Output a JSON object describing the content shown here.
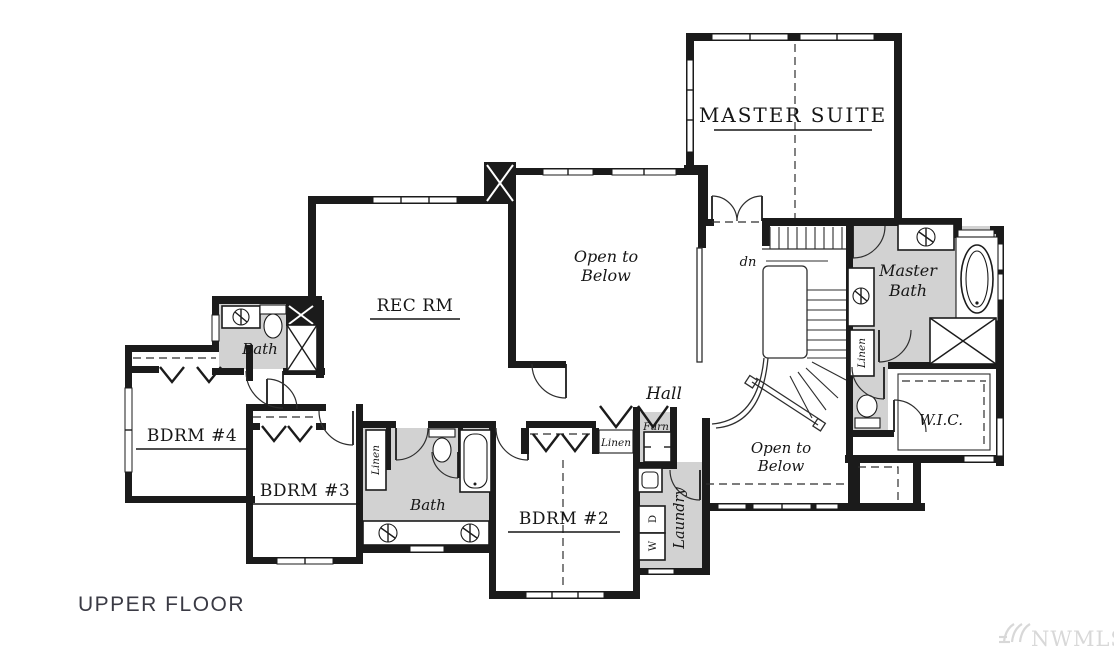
{
  "plan": {
    "floor_label": "UPPER FLOOR",
    "watermark_text": "NWMLS",
    "colors": {
      "wall": "#1b1b1b",
      "room_shading": "#d2d2d2",
      "thin_line": "#2e2e2e",
      "label_text": "#161616",
      "floor_label_text": "#3a3a44",
      "watermark": "#d8d8d8",
      "background": "#ffffff"
    },
    "rooms": {
      "master_suite": "MASTER SUITE",
      "rec_room": "REC RM",
      "open_to_below_upper_line1": "Open to",
      "open_to_below_upper_line2": "Below",
      "open_to_below_lower_line1": "Open to",
      "open_to_below_lower_line2": "Below",
      "hall": "Hall",
      "bath_upper": "Bath",
      "bath_lower": "Bath",
      "bedroom4": "BDRM #4",
      "bedroom3": "BDRM #3",
      "bedroom2": "BDRM #2",
      "master_bath_line1": "Master",
      "master_bath_line2": "Bath",
      "walk_in_closet": "W.I.C.",
      "laundry": "Laundry",
      "furnace": "Furn",
      "linen_bath": "Linen",
      "linen_hall": "Linen",
      "linen_master": "Linen",
      "washer": "W",
      "dryer": "D",
      "stairs_direction": "dn"
    },
    "icons": {
      "sink": "circle-with-spokes",
      "toilet": "tank-and-bowl",
      "bathtub": "oval-in-rect",
      "shower": "x-box",
      "chimney": "black-x-box",
      "closet_door": "chevron-v",
      "stairs": "tread-lines"
    }
  }
}
